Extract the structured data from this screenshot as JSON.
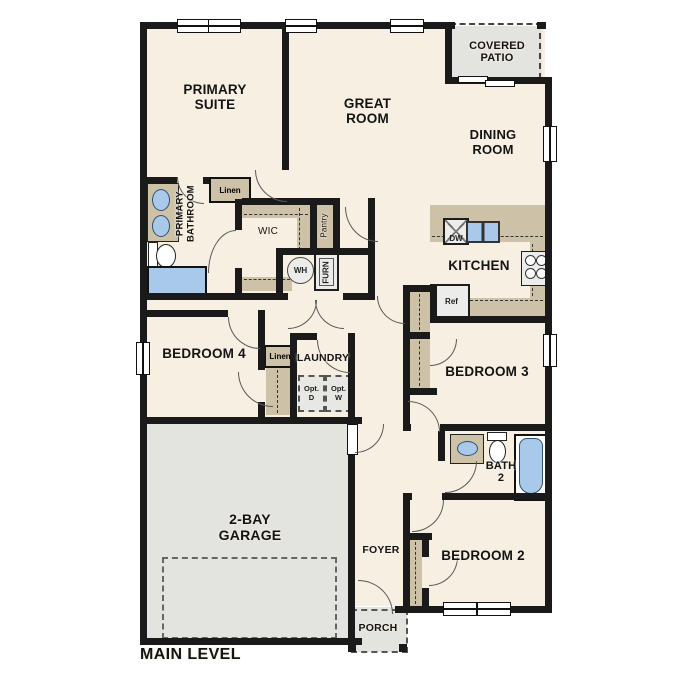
{
  "plan_title": "MAIN LEVEL",
  "colors": {
    "floor": "#f6efe2",
    "wall": "#1a1a1a",
    "garage_patio_gray": "#e3e3e0",
    "counter_tan": "#cdc1a7",
    "fixture_blue": "#a9c9ea",
    "appliance_gray": "#ececea"
  },
  "rooms": {
    "primary_suite": "PRIMARY\nSUITE",
    "great_room": "GREAT\nROOM",
    "covered_patio": "COVERED\nPATIO",
    "dining_room": "DINING\nROOM",
    "kitchen": "KITCHEN",
    "primary_bathroom": "PRIMARY\nBATHROOM",
    "wic": "WIC",
    "bedroom4": "BEDROOM 4",
    "laundry": "LAUNDRY",
    "bedroom3": "BEDROOM 3",
    "bath2": "BATH\n2",
    "bedroom2": "BEDROOM 2",
    "foyer": "FOYER",
    "porch": "PORCH",
    "garage": "2-BAY\nGARAGE"
  },
  "closets": {
    "linen_bath": "Linen",
    "linen_hall": "Linen",
    "pantry": "Pantry"
  },
  "appliances": {
    "dishwasher": "DW",
    "refrigerator": "Ref",
    "water_heater": "WH",
    "furnace": "FURN",
    "optional_dryer": "Opt.\nD",
    "optional_washer": "Opt.\nW"
  }
}
